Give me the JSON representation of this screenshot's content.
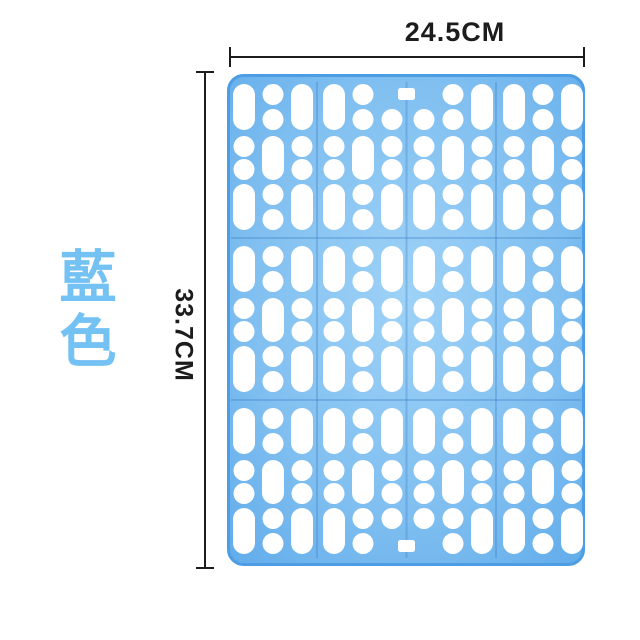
{
  "figure": {
    "width_label": "24.5CM",
    "height_label": "33.7CM",
    "color_label": "藍色",
    "label_color": "#74c2f3",
    "line_color": "#1c1c1c",
    "background": "#ffffff"
  },
  "product": {
    "name": "blue-perforated-plastic-mat",
    "hole_color": "#ffffff",
    "body_color_center": "#9ed2f7",
    "body_color_mid": "#80bff0",
    "body_color_edge": "#5ba8ea",
    "outline_color": "#4d9de4",
    "seam_color": "rgba(60,130,200,0.35)",
    "grid": {
      "width": 358,
      "height": 492,
      "corner_radius": 15,
      "col_groups": 4,
      "group_pitch": 90,
      "group_origin_x": 6,
      "col_offsets": [
        0,
        29,
        58
      ],
      "col_width": 22,
      "hole_radius": 10.5,
      "rows": [
        {
          "y": 10,
          "h": 46,
          "type": "A",
          "variant": "top-slot"
        },
        {
          "y": 62,
          "h": 44,
          "type": "B"
        },
        {
          "y": 110,
          "h": 46,
          "type": "A"
        },
        {
          "y": 172,
          "h": 46,
          "type": "A"
        },
        {
          "y": 224,
          "h": 44,
          "type": "B"
        },
        {
          "y": 272,
          "h": 46,
          "type": "A"
        },
        {
          "y": 334,
          "h": 46,
          "type": "A"
        },
        {
          "y": 386,
          "h": 44,
          "type": "B"
        },
        {
          "y": 434,
          "h": 46,
          "type": "A",
          "variant": "bottom-slot"
        }
      ],
      "seam_ys": [
        164,
        326
      ],
      "seam_xs": [
        90,
        179.5,
        269
      ],
      "slot": {
        "cx": 179.5,
        "w": 17,
        "h": 12
      }
    }
  }
}
